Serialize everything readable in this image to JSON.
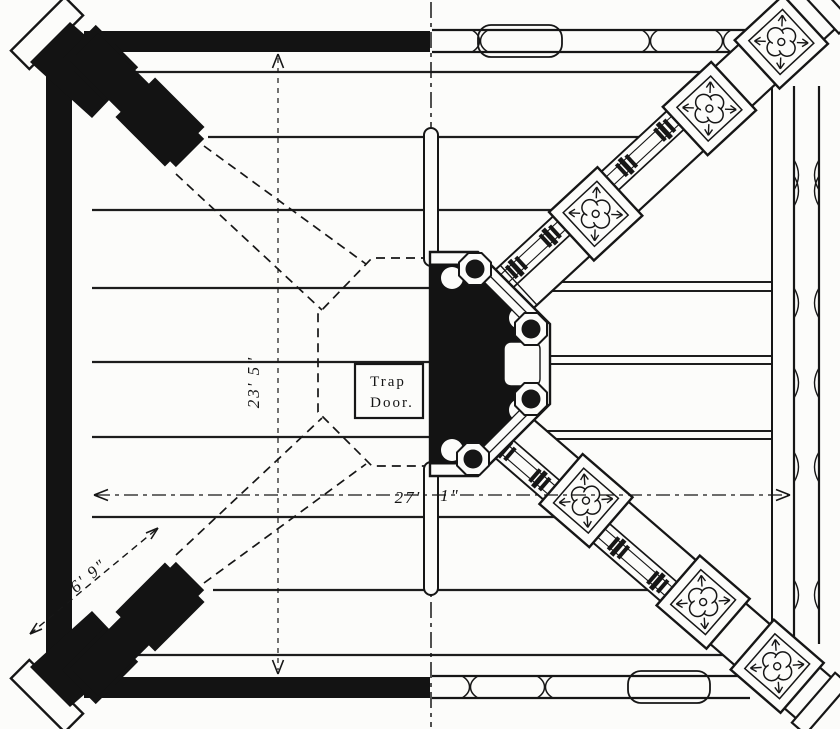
{
  "drawing": {
    "title_hint": "tower-framing-half-plan",
    "paper_color": "#fcfcfa",
    "ink_color": "#161616"
  },
  "labels": {
    "trap_door_line1": "Trap",
    "trap_door_line2": "Door."
  },
  "dimensions": {
    "interior_height": "23' 5\"",
    "interior_width_feet": "27'",
    "interior_width_inches": "1\"",
    "corner_brace": "6' 9\""
  }
}
